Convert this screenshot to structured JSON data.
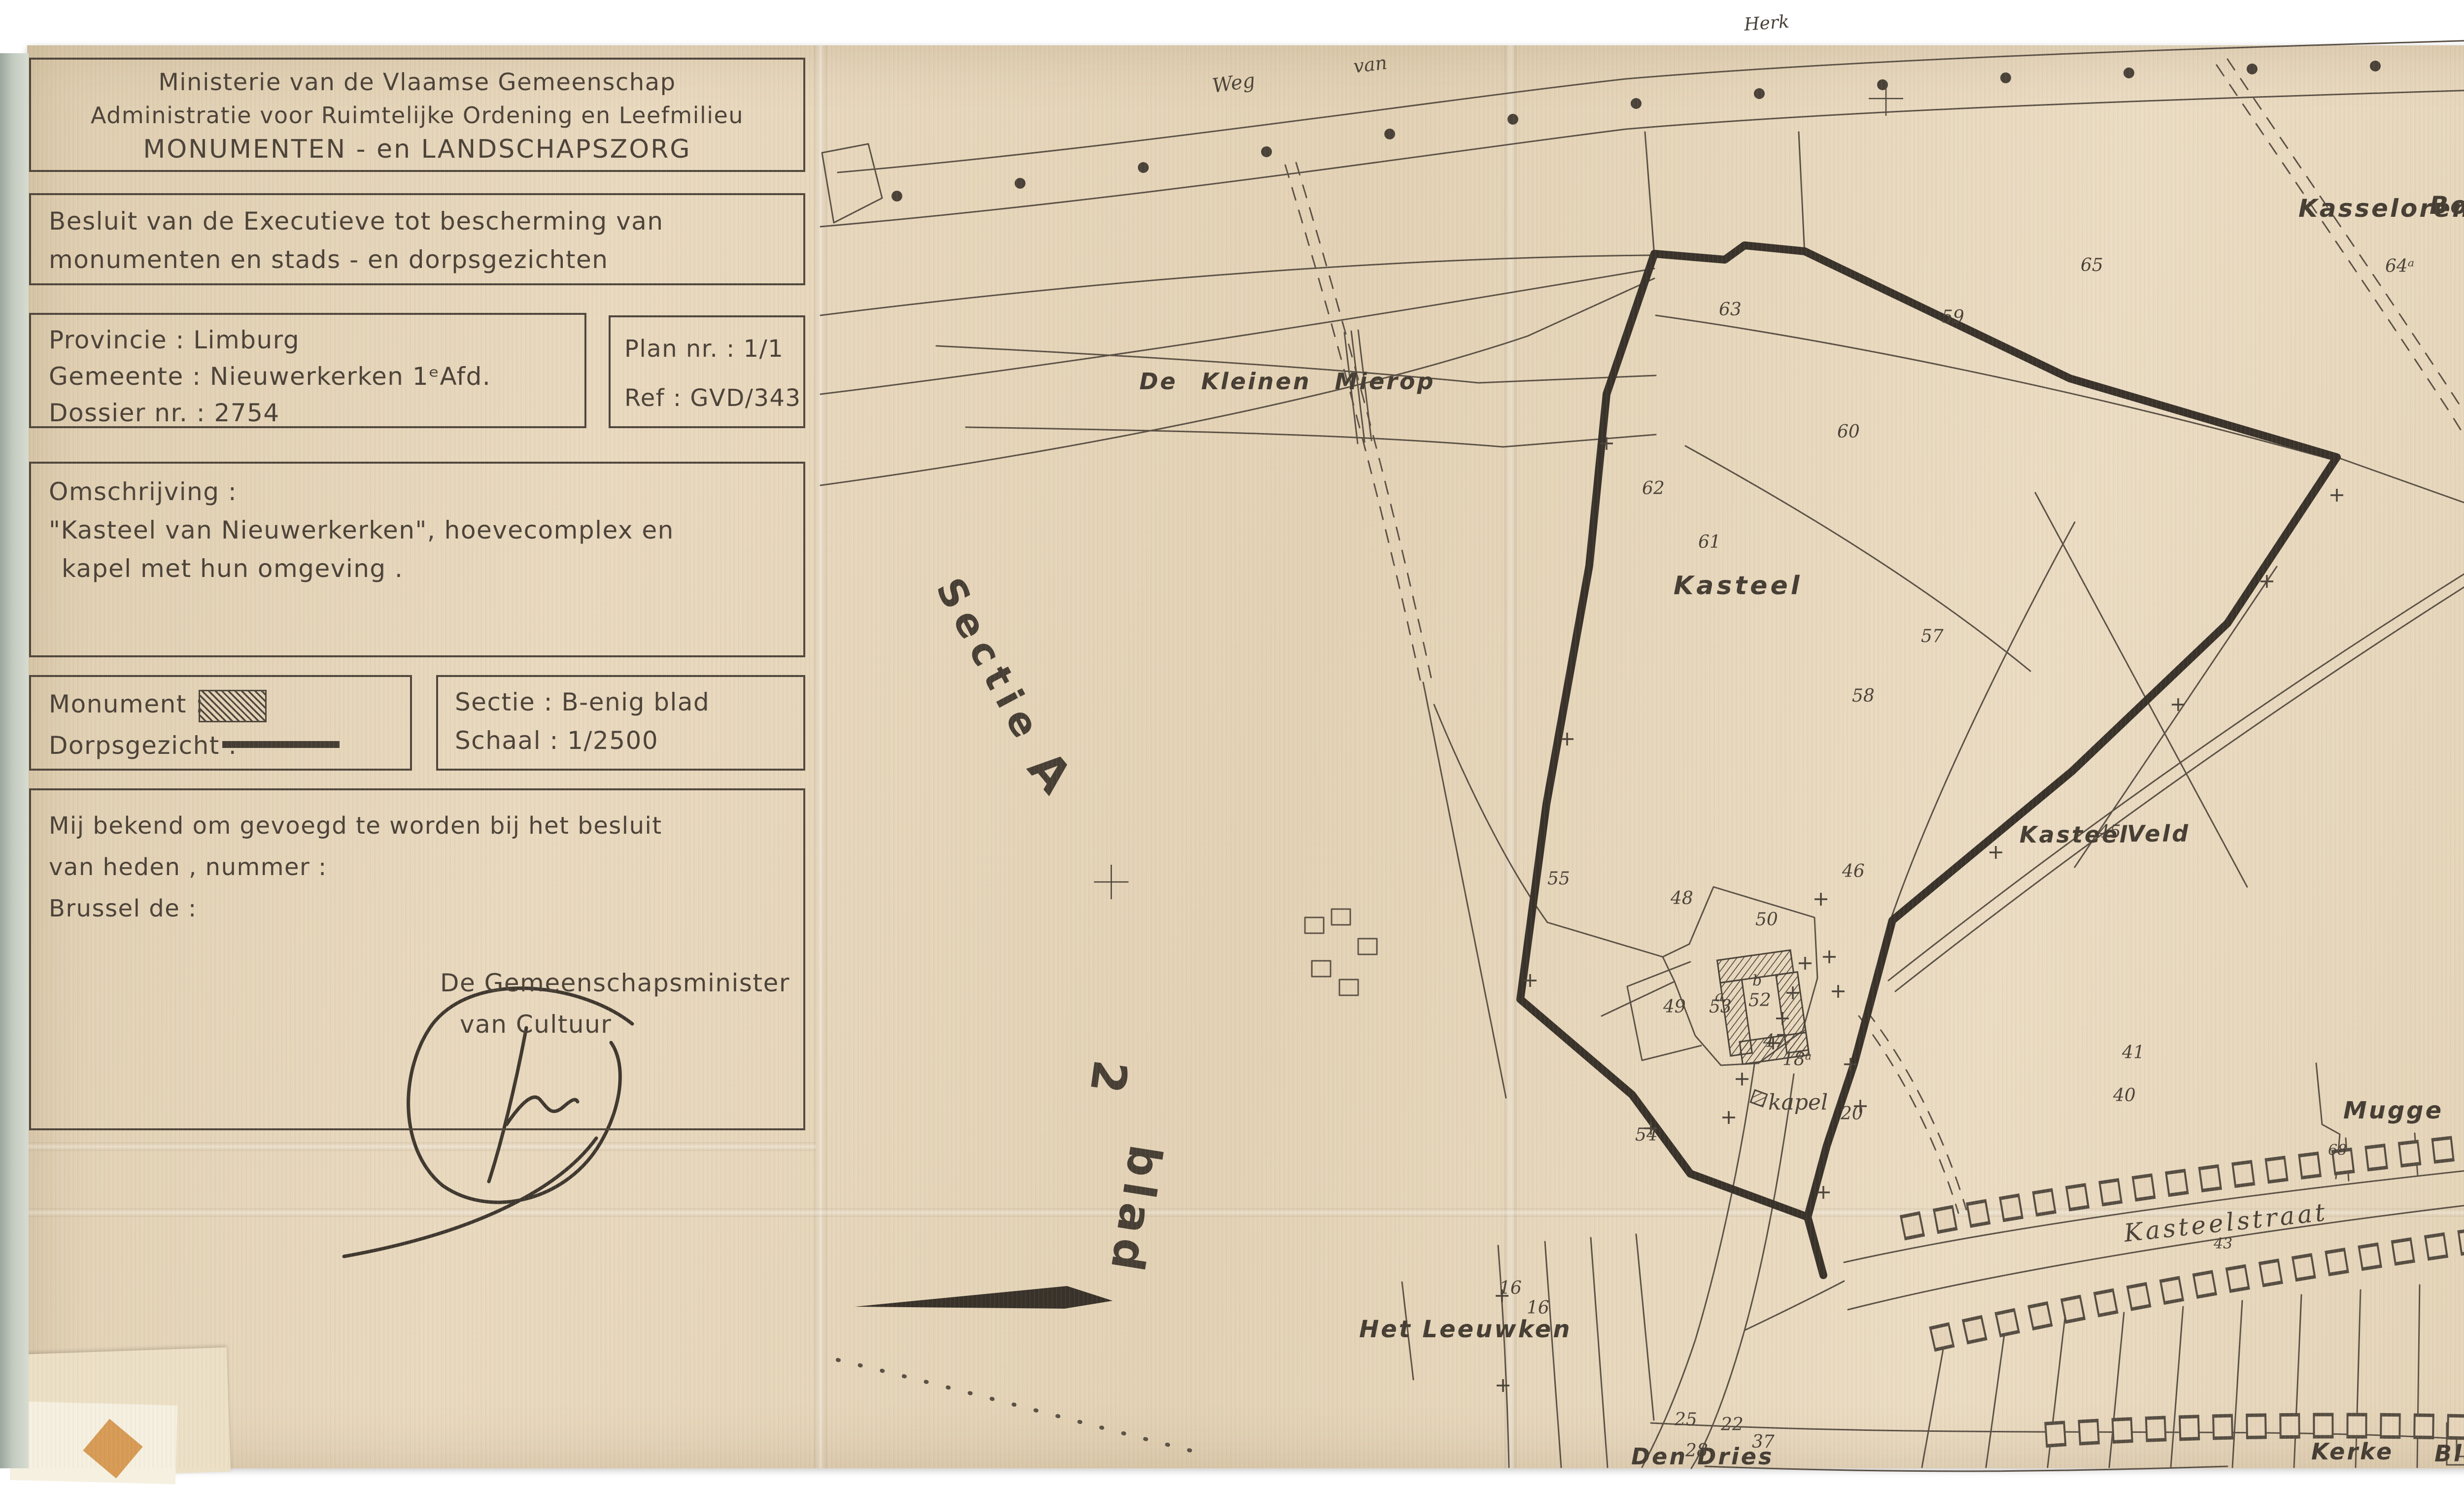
{
  "document": {
    "header": {
      "line1": "Ministerie van de Vlaamse Gemeenschap",
      "line2": "Administratie voor Ruimtelijke Ordening en Leefmilieu",
      "line3": "MONUMENTEN - en LANDSCHAPSZORG"
    },
    "decree": {
      "line1": "Besluit van de Executieve tot bescherming van",
      "line2": "monumenten en stads - en dorpsgezichten"
    },
    "dossier": {
      "province": "Provincie : Limburg",
      "municipality": "Gemeente : Nieuwerkerken 1ᵉAfd.",
      "number": "Dossier nr. : 2754"
    },
    "plan": {
      "nr": "Plan nr. : 1/1",
      "ref": "Ref : GVD/343"
    },
    "description": {
      "label": "Omschrijving :",
      "line1": "\"Kasteel van Nieuwerkerken\", hoevecomplex en",
      "line2": "kapel met hun omgeving ."
    },
    "legend": {
      "monument": "Monument :",
      "dorpsgezicht": "Dorpsgezicht :"
    },
    "sheet": {
      "sectie": "Sectie : B-enig blad",
      "schaal": "Schaal : 1/2500"
    },
    "annex": {
      "line1": "Mij bekend om gevoegd te worden bij het besluit",
      "line2": "van heden , nummer :",
      "line3": "Brussel de :",
      "signatory_line1": "De Gemeenschapsminister",
      "signatory_line2": "van Cultuur"
    },
    "colors": {
      "paper": "#e6d5ba",
      "ink": "#4b4238",
      "map_line": "#5a5045",
      "boundary": "#38322a"
    }
  },
  "map": {
    "labels": {
      "kasseloren": "Kasseloren",
      "bosch": "Bosch",
      "kleinen_mierop": "De Kleinen Mierop",
      "kasteel": "Kasteel",
      "kveld1": "Kasteel",
      "kveld2": "Veld",
      "mugge": "Mugge Boschken",
      "kasteelstraat": "Kasteelstraat",
      "leeuwken": "Het Leeuwken",
      "dendries": "Den Dries",
      "kerke": "Kerke",
      "blank": "Blank",
      "kapel": "kapel",
      "weg": "Weg",
      "van": "van",
      "herk": "Herk",
      "sectie": "Sectie",
      "a": "A",
      "two": "2",
      "blad": "blad"
    },
    "parcels": [
      "65",
      "63",
      "59",
      "60",
      "62",
      "61",
      "58",
      "55",
      "46",
      "45",
      "48",
      "50",
      "52",
      "53",
      "49",
      "47",
      "54",
      "41",
      "40",
      "20",
      "16",
      "64ᵃ",
      "68",
      "43",
      "25",
      "22",
      "37",
      "28",
      "18ᵃ",
      "b",
      "a",
      "57"
    ]
  }
}
